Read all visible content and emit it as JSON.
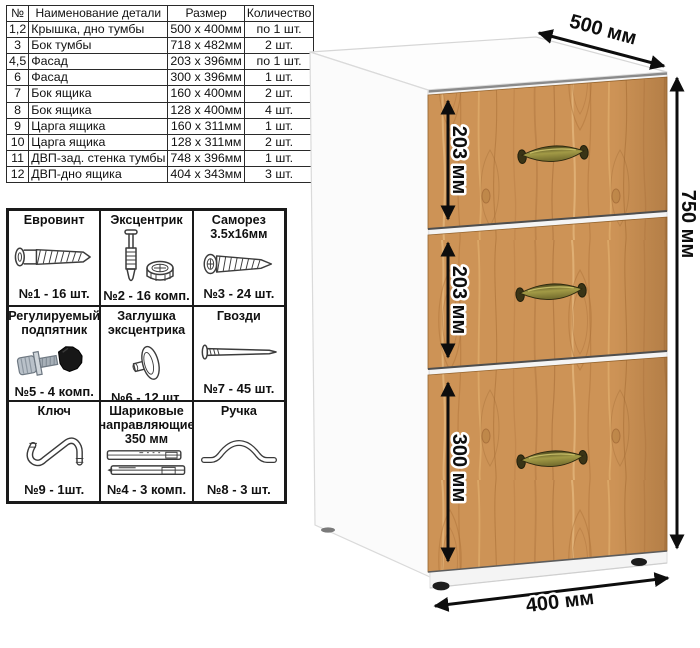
{
  "parts_table": {
    "headers": [
      "№",
      "Наименование детали",
      "Размер",
      "Количество"
    ],
    "rows": [
      [
        "1,2",
        "Крышка, дно тумбы",
        "500 x 400мм",
        "по 1 шт."
      ],
      [
        "3",
        "Бок тумбы",
        "718 x 482мм",
        "2 шт."
      ],
      [
        "4,5",
        "Фасад",
        "203 x 396мм",
        "по 1 шт."
      ],
      [
        "6",
        "Фасад",
        "300 x 396мм",
        "1 шт."
      ],
      [
        "7",
        "Бок ящика",
        "160 x 400мм",
        "2 шт."
      ],
      [
        "8",
        "Бок ящика",
        "128 x 400мм",
        "4 шт."
      ],
      [
        "9",
        "Царга ящика",
        "160 x 311мм",
        "1 шт."
      ],
      [
        "10",
        "Царга ящика",
        "128 x 311мм",
        "2 шт."
      ],
      [
        "11",
        "ДВП-зад. стенка тумбы",
        "748 x 396мм",
        "1 шт."
      ],
      [
        "12",
        "ДВП-дно ящика",
        "404 x 343мм",
        "3 шт."
      ]
    ]
  },
  "hardware": {
    "cells": [
      {
        "title": "Евровинт",
        "count": "№1 - 16 шт.",
        "icon": "euro-screw-icon"
      },
      {
        "title": "Эксцентрик",
        "count": "№2 - 16 комп.",
        "icon": "eccentric-cam-icon"
      },
      {
        "title": "Саморез\n3.5х16мм",
        "count": "№3 - 24 шт.",
        "icon": "self-tapping-screw-icon"
      },
      {
        "title": "Регулируемый\nподпятник",
        "count": "№5 - 4 комп.",
        "icon": "adjustable-foot-icon"
      },
      {
        "title": "Заглушка\nэксцентрика",
        "count": "№6 - 12 шт.",
        "icon": "cam-cap-icon"
      },
      {
        "title": "Гвозди",
        "count": "№7 - 45 шт.",
        "icon": "nail-icon"
      },
      {
        "title": "Ключ",
        "count": "№9 - 1шт.",
        "icon": "hex-key-icon"
      },
      {
        "title": "Шариковые\nнаправляющие\n350 мм",
        "count": "№4 - 3 комп.",
        "icon": "drawer-slides-icon"
      },
      {
        "title": "Ручка",
        "count": "№8 - 3 шт.",
        "icon": "handle-icon"
      }
    ]
  },
  "cabinet": {
    "labels": {
      "depth": "500 мм",
      "height": "750 мм",
      "width": "400 мм",
      "drawer_1": "203 мм",
      "drawer_2": "203 мм",
      "drawer_3": "300 мм"
    },
    "colors": {
      "wood": "#cd9356",
      "wood_grain_dark": "#a96e38",
      "wood_grain_light": "#e3b77c",
      "handle_brass": "#8d8536",
      "dimension_ink": "#0d0d0d",
      "body_white": "#ffffff"
    }
  }
}
